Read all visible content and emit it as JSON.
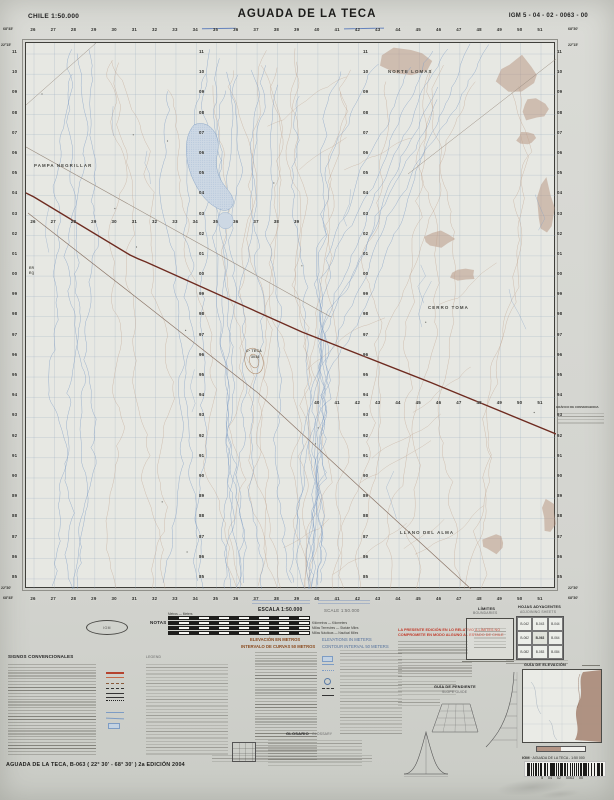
{
  "header": {
    "country_scale": "CHILE  1:50.000",
    "title": "AGUADA DE LA TECA",
    "sheet_code": "IGM 5 - 04 - 02 - 0063 - 00"
  },
  "map": {
    "grid_sequences": [
      {
        "name": "top-eastings",
        "type": "h",
        "start": 26,
        "step": 1,
        "count": 26,
        "x0": 33,
        "dx": 20.28,
        "y": 26.5
      },
      {
        "name": "bottom-eastings",
        "type": "h",
        "start": 26,
        "step": 1,
        "count": 26,
        "x0": 33,
        "dx": 20.28,
        "y": 596
      },
      {
        "name": "interior-eastings-a",
        "type": "h",
        "start": 26,
        "step": 1,
        "count": 14,
        "x0": 33,
        "dx": 20.28,
        "y": 219
      },
      {
        "name": "interior-eastings-b",
        "type": "h",
        "start": 40,
        "step": 1,
        "count": 12,
        "x0": 316.9,
        "dx": 20.28,
        "y": 399.5
      },
      {
        "name": "left-northings",
        "type": "v",
        "start": 11,
        "step": -1,
        "count": 27,
        "y0": 49,
        "dy": 20.19,
        "x": 12
      },
      {
        "name": "right-northings",
        "type": "v",
        "start": 11,
        "step": -1,
        "count": 27,
        "y0": 49,
        "dy": 20.19,
        "x": 557
      },
      {
        "name": "interior-northings-a",
        "type": "v",
        "start": 11,
        "step": -1,
        "count": 27,
        "y0": 49,
        "dy": 20.19,
        "x": 199
      },
      {
        "name": "interior-northings-b",
        "type": "v",
        "start": 11,
        "step": -1,
        "count": 27,
        "y0": 49,
        "dy": 20.19,
        "x": 363
      }
    ],
    "corner_labels": [
      {
        "text": "68°45'",
        "x": 3,
        "y": 26.5
      },
      {
        "text": "68°30'",
        "x": 568,
        "y": 26.5
      },
      {
        "text": "22°15'",
        "x": 1,
        "y": 43
      },
      {
        "text": "22°15'",
        "x": 568,
        "y": 43
      },
      {
        "text": "22°30'",
        "x": 1,
        "y": 586
      },
      {
        "text": "22°30'",
        "x": 568,
        "y": 586
      },
      {
        "text": "68°45'",
        "x": 3,
        "y": 596
      },
      {
        "text": "68°30'",
        "x": 568,
        "y": 596
      }
    ],
    "place_labels": [
      {
        "text": "PAMPA NEGRILLAR",
        "x": 34,
        "y": 163,
        "cls": "place"
      },
      {
        "text": "NORTE LOMAS",
        "x": 388,
        "y": 69,
        "cls": "place"
      },
      {
        "text": "CERRO TOMA",
        "x": 428,
        "y": 305,
        "cls": "place"
      },
      {
        "text": "Cº TECA",
        "x": 246,
        "y": 349,
        "cls": "place-sm"
      },
      {
        "text": "3046",
        "x": 251,
        "y": 355,
        "cls": "place-sm"
      },
      {
        "text": "LLANO DEL ALMA",
        "x": 400,
        "y": 530,
        "cls": "place"
      },
      {
        "text": "ER",
        "x": 29,
        "y": 266,
        "cls": "place-sm"
      },
      {
        "text": "EQ",
        "x": 29,
        "y": 271,
        "cls": "place-sm"
      }
    ],
    "margin_graph_title": "GRÁFICO DE CONVERGENCIA"
  },
  "legend": {
    "signos": "SIGNOS CONVENCIONALES",
    "legend_en": "LEGEND",
    "notas": "NOTAS",
    "escala": "ESCALA 1:50.000",
    "escala_en": "SCALE 1:50.000",
    "metros_label": "Metros — Meters",
    "scalebar_labels": [
      "Kilómetros — Kilometers",
      "Millas Terrestres — Statute Miles",
      "Millas Náuticas — Nautical Miles"
    ],
    "elev_es": "ELEVACIÓN EN METROS",
    "elev_en": "ELEVATIONS IN METERS",
    "interval_es": "INTERVALO DE CURVAS 50 METROS",
    "interval_en": "CONTOUR INTERVAL 50 METERS",
    "warning_red_1": "LA PRESENTE EDICIÓN EN LO RELATIVO A LÍMITES NO",
    "warning_red_2": "COMPROMETE EN MODO ALGUNO AL ESTADO DE CHILE",
    "limites": "LÍMITES",
    "limites_en": "BOUNDARIES",
    "hojas": "HOJAS ADYACENTES",
    "hojas_en": "ADJOINING SHEETS",
    "adjoining_sheets": [
      "B-042",
      "B-043",
      "B-044",
      "B-062",
      "B-063",
      "B-064",
      "B-082",
      "B-083",
      "B-084"
    ],
    "pendiente": "GUÍA DE PENDIENTE",
    "pendiente_en": "SLOPE GUIDE",
    "elevacion_guia": "GUÍA DE ELEVACIÓN",
    "glosario": "GLOSARIO",
    "glosario_en": "GLOSSARY",
    "logo_label": "IGM"
  },
  "footer": {
    "sheet_line": "AGUADA DE LA TECA, B-063  ( 22° 30' - 68° 30' )  2a EDICIÓN 2004",
    "barcode_title": "AGUADA DE LA TECA - 1:50 000",
    "barcode_igm": "IGM",
    "barcode_digits": "5     04     02     0063     00"
  },
  "colors": {
    "grid": "#8fa3ba",
    "water": "#7d9cc4",
    "contour": "#bfa18c",
    "terrain": "#b5927e",
    "road": "#6e2b20",
    "track": "#8b7567",
    "lake_fill": "#cdd8e4",
    "lake_edge": "#8aa6c8",
    "red_note": "#c23b2a"
  }
}
